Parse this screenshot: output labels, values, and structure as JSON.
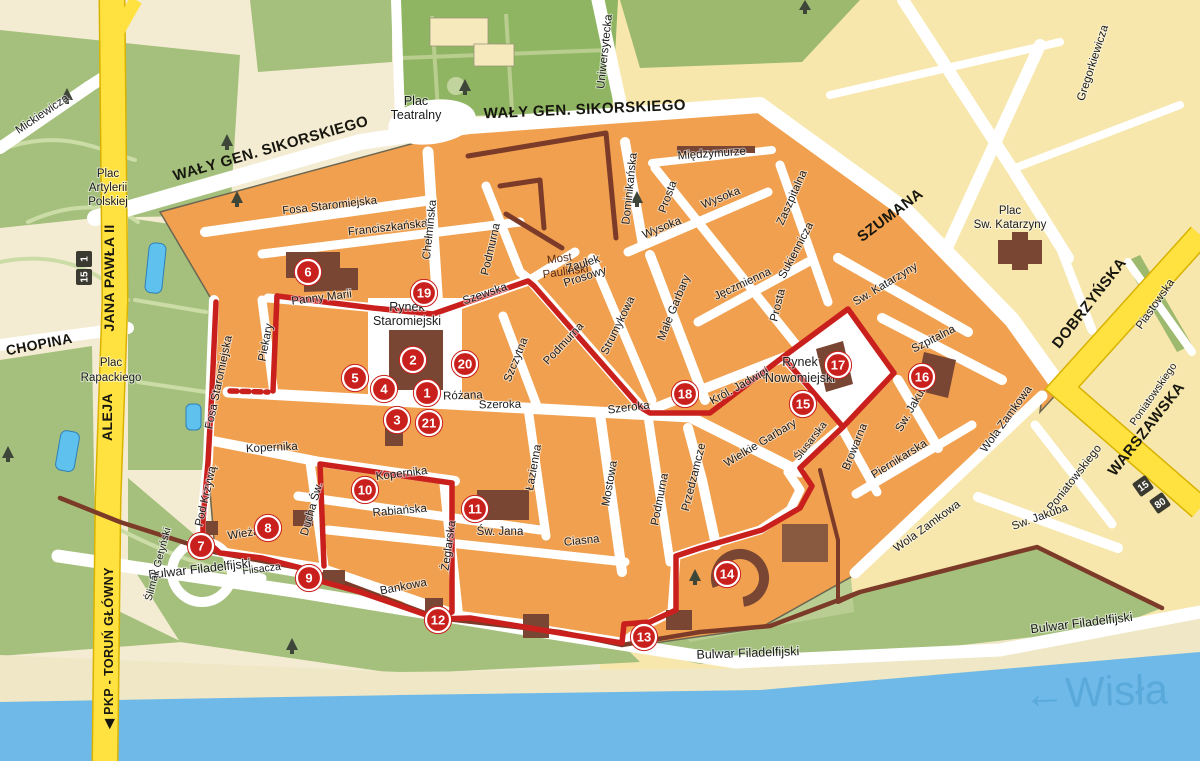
{
  "region": {
    "river_label": "←Wisła"
  },
  "route": {
    "color": "#c9201d",
    "markers": [
      {
        "label": "1"
      },
      {
        "label": "2"
      },
      {
        "label": "3"
      },
      {
        "label": "4"
      },
      {
        "label": "5"
      },
      {
        "label": "6"
      },
      {
        "label": "7"
      },
      {
        "label": "8"
      },
      {
        "label": "9"
      },
      {
        "label": "10"
      },
      {
        "label": "11"
      },
      {
        "label": "12"
      },
      {
        "label": "13"
      },
      {
        "label": "14"
      },
      {
        "label": "15"
      },
      {
        "label": "16"
      },
      {
        "label": "17"
      },
      {
        "label": "18"
      },
      {
        "label": "19"
      },
      {
        "label": "20"
      },
      {
        "label": "21"
      }
    ]
  },
  "road_shields": [
    {
      "text": "1"
    },
    {
      "text": "15"
    },
    {
      "text": "15"
    },
    {
      "text": "80"
    }
  ],
  "streets": {
    "mickiewicza": "Mickiewicza",
    "waly": "WAŁY GEN. SIKORSKIEGO",
    "szumana": "SZUMANA",
    "uniwersytecka": "Uniwersytecka",
    "gregorkiewicza": "Gregorkiewicza",
    "dobrzynska": "DOBRZYŃSKA",
    "warszawska": "WARSZAWSKA",
    "piastowska": "Piastowska",
    "poniatowskiego": "Poniatowskiego",
    "chopina": "CHOPINA",
    "jana_pawla": "JANA PAWŁA II",
    "aleja": "ALEJA",
    "pkp": "◀ PKP - TORUŃ GŁÓWNY",
    "fosa_staromiejska": "Fosa Staromiejska",
    "franciszkanska": "Franciszkańska",
    "chelminska": "Chełmińska",
    "podmurna": "Podmurna",
    "dominikanska": "Dominikańska",
    "miedzymurze": "Międzymurze",
    "prosta": "Prosta",
    "wysoka": "Wysoka",
    "zaszpitalna": "Zaszpitalna",
    "sukiennicza": "Sukiennicza",
    "jeczmienna": "Jęczmienna",
    "male_garbary": "Małe Garbary",
    "strumykowa": "Strumykowa",
    "szewska": "Szewska",
    "szczytna": "Szczytna",
    "szeroka": "Szeroka",
    "rozana": "Różana",
    "panny_marii": "Panny Marii",
    "piekary": "Piekary",
    "pod_krzywa": "Pod Krzywą",
    "wieza": "Wieżą",
    "kopernika": "Kopernika",
    "rabianska": "Rabiańska",
    "ducha_sw": "Ducha Św.",
    "zeglarska": "Żeglarska",
    "lazienna": "Łazienna",
    "mostowa": "Mostowa",
    "ciasna": "Ciasna",
    "sw_jana": "Św. Jana",
    "flisacza": "Flisacza",
    "bankowa": "Bankowa",
    "bulwar": "Bulwar Filadelfijski",
    "slimak": "Ślimak Getyński",
    "przedzamcze": "Przedzamcze",
    "wielkie_garbary": "Wielkie Garbary",
    "krol_jadwigi": "Król. Jadwigi",
    "slusarska": "Ślusarska",
    "sw_katarzyny": "Sw. Katarzyny",
    "szpitalna": "Szpitalna",
    "sw_jakuba": "Sw. Jakuba",
    "browarna": "Browarna",
    "piernikarska": "Piernikarska",
    "wola_zamkowa": "Wola Zamkowa"
  },
  "places": {
    "plac_teatralny": {
      "lines": [
        "Plac",
        "Teatralny"
      ]
    },
    "plac_artylerii": {
      "lines": [
        "Plac",
        "Artylerii",
        "Polskiej"
      ]
    },
    "plac_rapackiego": {
      "lines": [
        "Plac",
        "Rapackiego"
      ]
    },
    "plac_sw_katarzyny": {
      "lines": [
        "Plac",
        "Sw. Katarzyny"
      ]
    },
    "rynek_staromiejski": {
      "lines": [
        "Rynek",
        "Staromiejski"
      ]
    },
    "rynek_nowomiejski": {
      "lines": [
        "Rynek",
        "Nowomiejski"
      ]
    },
    "zaulek_prosowy": {
      "lines": [
        "Zaułek",
        "Prosowy"
      ]
    },
    "most_paulinski": {
      "lines": [
        "Most",
        "Pauliński"
      ]
    }
  },
  "colors": {
    "old_town_block": "#f0a04e",
    "new_town_block": "#f7e7ac",
    "park": "#a5c07c",
    "water": "#6fb9e8",
    "route": "#c9201d",
    "main_road": "#ffe23f",
    "building": "#7a4634"
  }
}
